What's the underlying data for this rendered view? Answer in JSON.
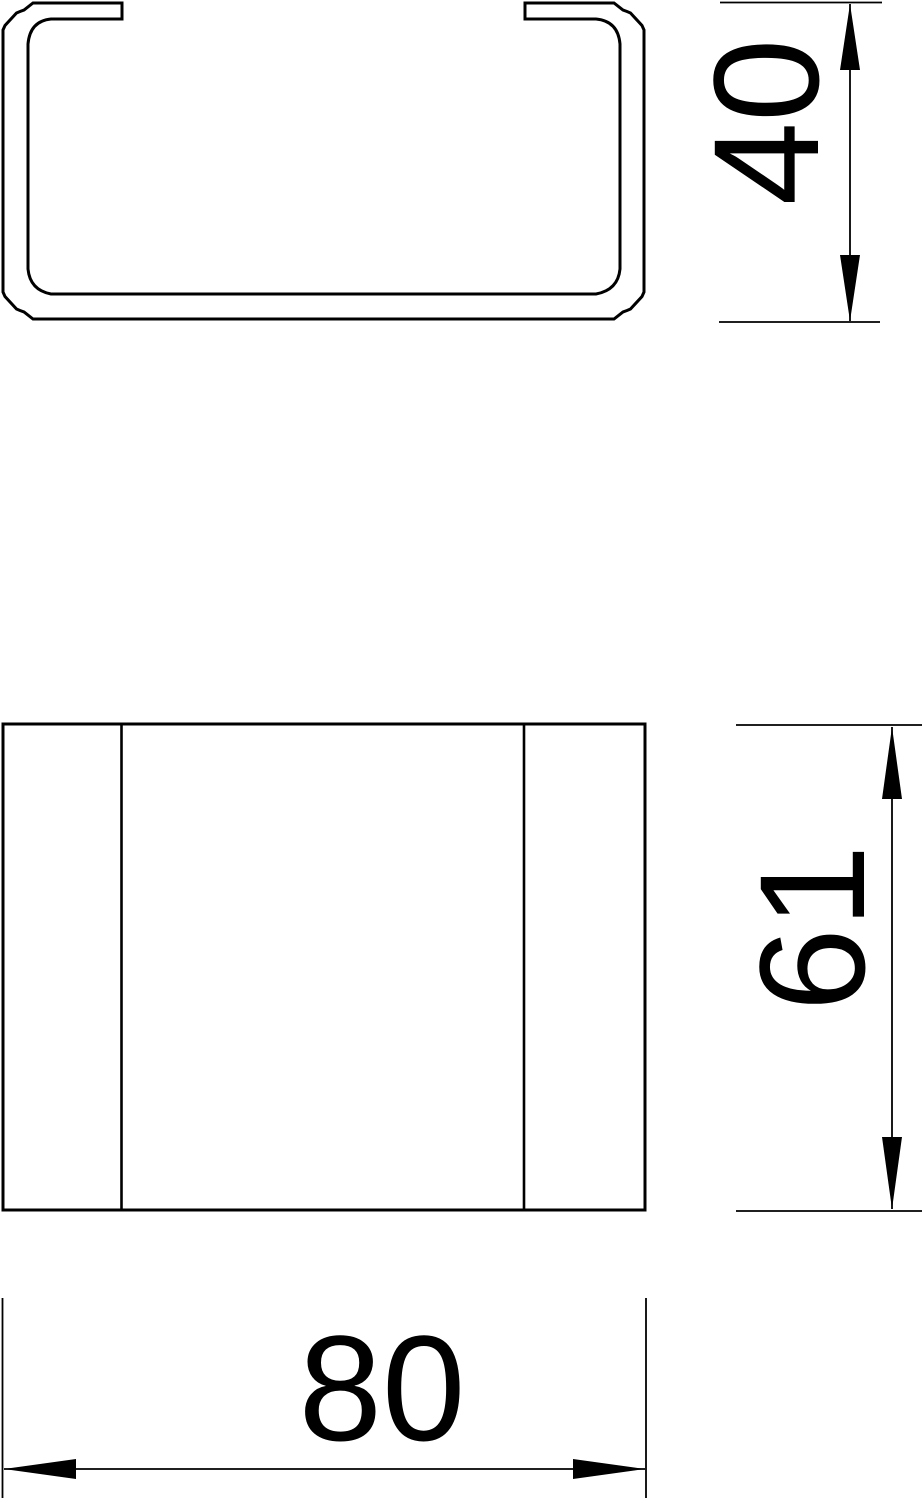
{
  "drawing": {
    "colors": {
      "line": "#000000",
      "background": "#ffffff"
    },
    "dimensions": {
      "profile_height": {
        "value": "40"
      },
      "front_height": {
        "value": "61"
      },
      "width": {
        "value": "80"
      }
    }
  }
}
